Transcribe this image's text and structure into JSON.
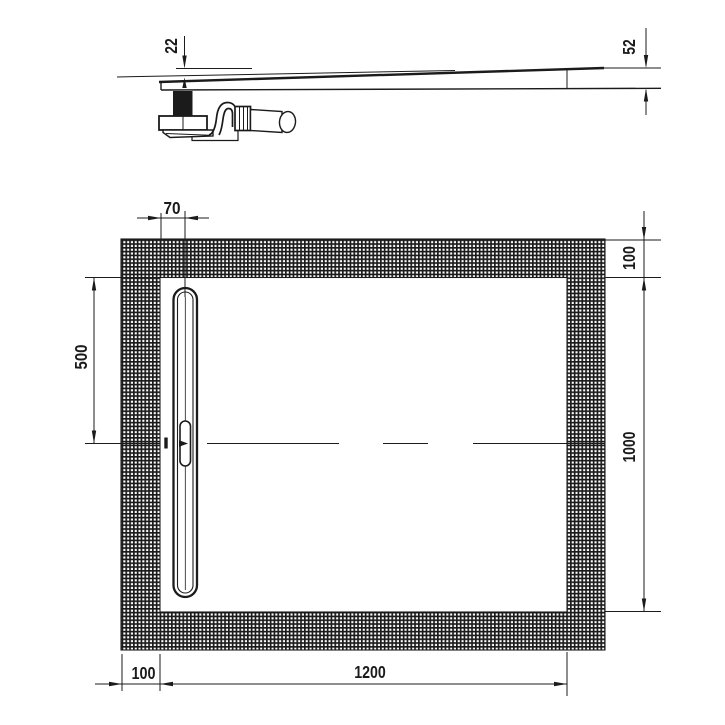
{
  "title": "shower-tray-technical-drawing",
  "colors": {
    "line": "#1b1b1b",
    "background": "#ffffff"
  },
  "section_view": {
    "dim_depth_at_drain": "22",
    "dim_edge_height": "52"
  },
  "plan_view": {
    "dim_drain_offset": "70",
    "dim_border_top": "100",
    "dim_drain_center_from_top": "500",
    "dim_inner_width": "1000",
    "dim_border_left": "100",
    "dim_inner_length": "1200"
  }
}
